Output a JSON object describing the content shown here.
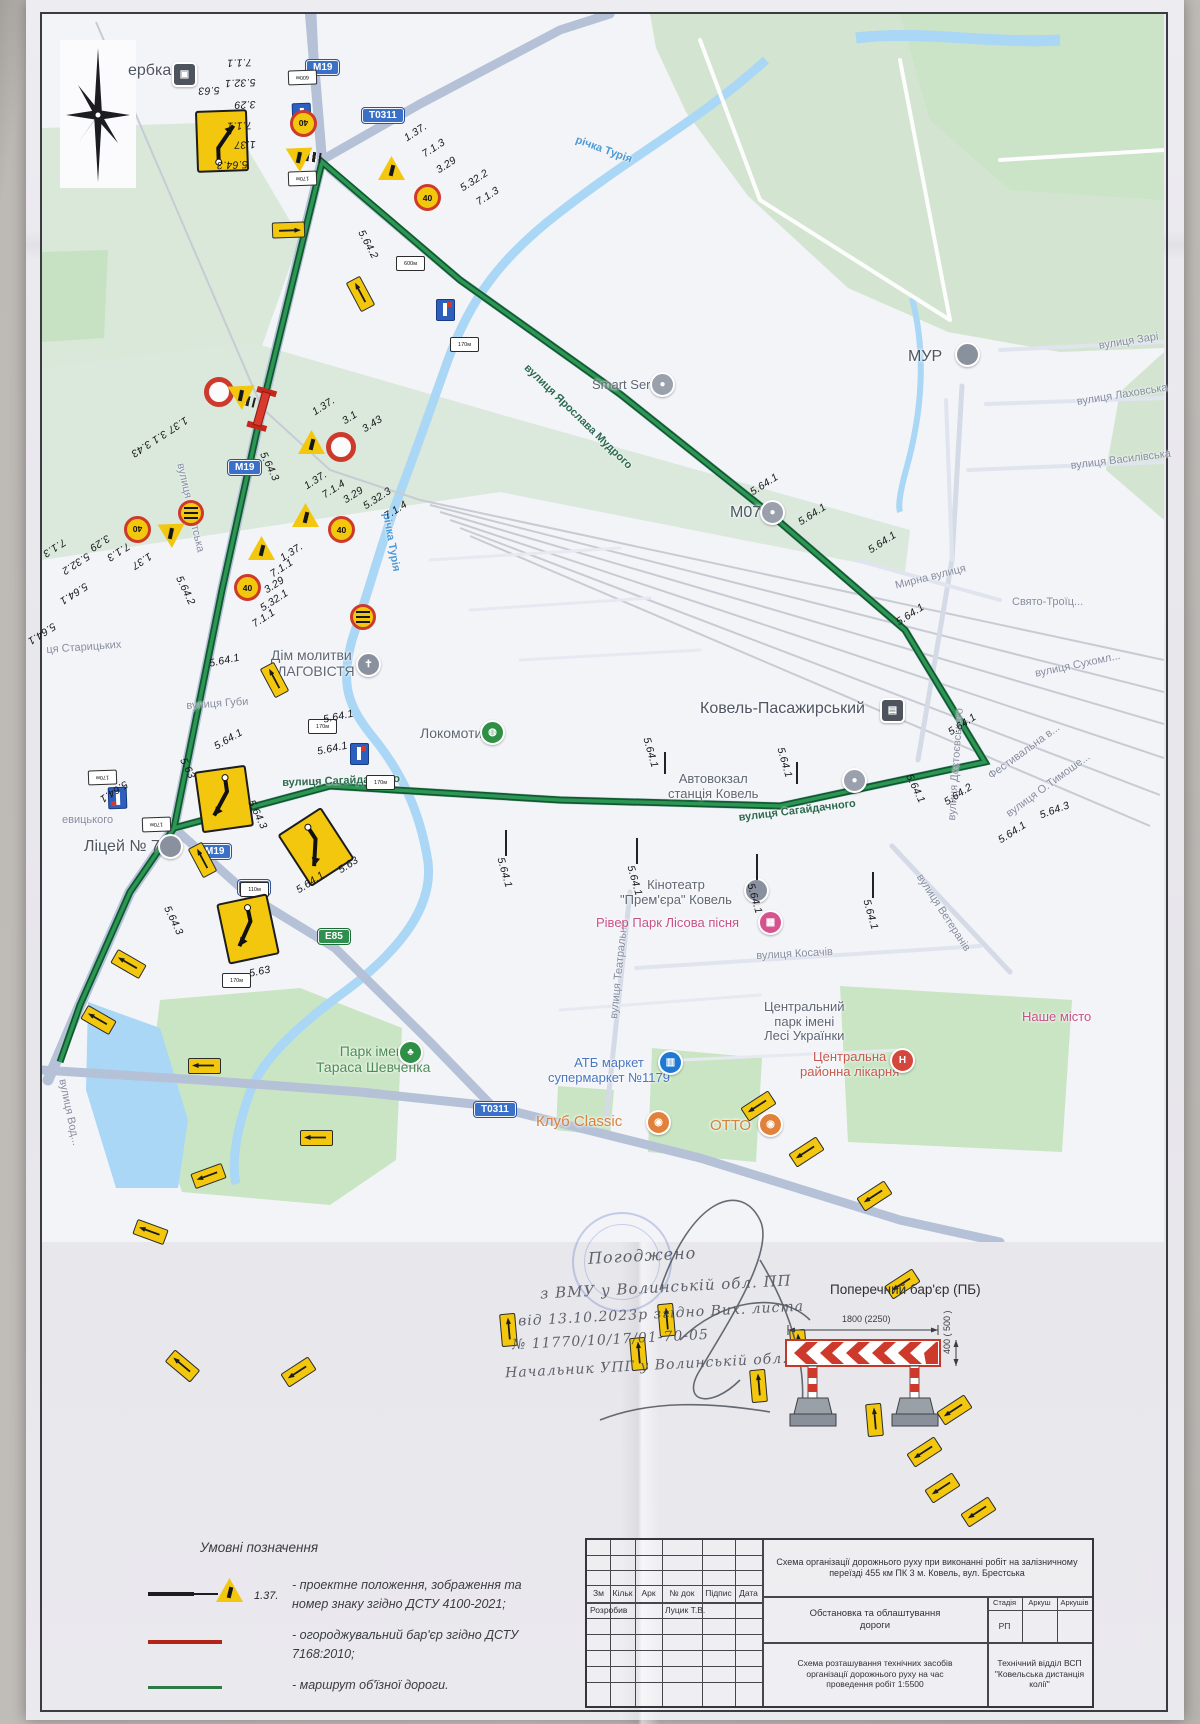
{
  "map": {
    "speed": "40",
    "plate_dist_600": "600м",
    "plate_dist_170": "170м",
    "plate_dist_110": "110м",
    "pois": [
      {
        "t": "ербка"
      },
      {
        "t": "МУР"
      },
      {
        "t": "Smart Service"
      },
      {
        "t": "М07"
      },
      {
        "t": "Дім молитви\nБЛАГОВІСТЯ"
      },
      {
        "t": "Локомотив"
      },
      {
        "t": "Ковель-Пасажирський"
      },
      {
        "t": "Автовокзал\nстанція Ковель"
      },
      {
        "t": "Кінотеатр\n\"Прем'єра\" Ковель"
      },
      {
        "t": "Рівер Парк Лісова пісня"
      },
      {
        "t": "Центральний\nпарк імені\nЛесі Українки"
      },
      {
        "t": "Наше місто"
      },
      {
        "t": "Центральна\nрайонна лікарня"
      },
      {
        "t": "АТБ маркет\nсупермаркет №1179"
      },
      {
        "t": "Клуб Classic"
      },
      {
        "t": "ОТТО"
      },
      {
        "t": "Парк імені\nТараса Шевченка"
      },
      {
        "t": "Ліцей № 7"
      }
    ],
    "streets": [
      {
        "t": "вулиця Зарі"
      },
      {
        "t": "вулиця Лаховська"
      },
      {
        "t": "вулиця Василівська"
      },
      {
        "t": "вулиця Достоєвського"
      },
      {
        "t": "Мирна вулиця"
      },
      {
        "t": "Свято-Троїц..."
      },
      {
        "t": "вулиця Сухомл..."
      },
      {
        "t": "вулиця Ярослава Мудрого"
      },
      {
        "t": "річка Турія"
      },
      {
        "t": "річка Турія"
      },
      {
        "t": "вулиця Брестська"
      },
      {
        "t": "ця Старицьких"
      },
      {
        "t": "вулиця Губи"
      },
      {
        "t": "вулиця Сагайдачного"
      },
      {
        "t": "вулиця Сагайдачного"
      },
      {
        "t": "вулиця Ветеранів"
      },
      {
        "t": "вулиця Театральна"
      },
      {
        "t": "вулиця Косачів"
      },
      {
        "t": "Фестивальна в..."
      },
      {
        "t": "вулиця О.Тимоше..."
      },
      {
        "t": "евицького"
      },
      {
        "t": "вулиця Вод..."
      }
    ],
    "shields": [
      {
        "t": "М19"
      },
      {
        "t": "Т0311"
      },
      {
        "t": "М19"
      },
      {
        "t": "М19"
      },
      {
        "t": "Р15"
      },
      {
        "t": "Е85"
      },
      {
        "t": "Т0311"
      }
    ],
    "signs": [
      {
        "t": "5.63"
      },
      {
        "t": "7.1.1"
      },
      {
        "t": "5.32.1"
      },
      {
        "t": "3.29"
      },
      {
        "t": "7.1.1"
      },
      {
        "t": "1.37"
      },
      {
        "t": "5.64.3"
      },
      {
        "t": "5.64.2"
      },
      {
        "t": "1.37."
      },
      {
        "t": "7.1.3"
      },
      {
        "t": "3.29"
      },
      {
        "t": "5.32.2"
      },
      {
        "t": "7.1.3"
      },
      {
        "t": "1.37  3.1  3.43"
      },
      {
        "t": "1.37."
      },
      {
        "t": "3.1"
      },
      {
        "t": "3.43"
      },
      {
        "t": "5.64.3"
      },
      {
        "t": "1.37."
      },
      {
        "t": "7.1.4"
      },
      {
        "t": "3.29"
      },
      {
        "t": "5.32.3"
      },
      {
        "t": "7.1.4"
      },
      {
        "t": "7.1.3"
      },
      {
        "t": "5.32.2"
      },
      {
        "t": "3.29"
      },
      {
        "t": "7.1.3"
      },
      {
        "t": "1.37"
      },
      {
        "t": "5.64.2"
      },
      {
        "t": "1.37."
      },
      {
        "t": "7.1.1"
      },
      {
        "t": "3.29"
      },
      {
        "t": "5.32.1"
      },
      {
        "t": "7.1.1"
      },
      {
        "t": "5.64.1"
      },
      {
        "t": "5.64.1"
      },
      {
        "t": "5.64.1"
      },
      {
        "t": "5.64.1"
      },
      {
        "t": "5.64.1"
      },
      {
        "t": "5.63"
      },
      {
        "t": "5.64.1"
      },
      {
        "t": "5.64.3"
      },
      {
        "t": "5.63"
      },
      {
        "t": "5.64.3"
      },
      {
        "t": "5.64.1"
      },
      {
        "t": "5.63"
      },
      {
        "t": "5.64.1"
      },
      {
        "t": "5.64.1"
      },
      {
        "t": "5.64.1"
      },
      {
        "t": "5.64.1"
      },
      {
        "t": "5.64.1"
      },
      {
        "t": "5.64.1"
      },
      {
        "t": "5.64.1"
      },
      {
        "t": "5.64.1"
      },
      {
        "t": "5.64.1"
      },
      {
        "t": "5.64.1"
      },
      {
        "t": "5.64.1"
      },
      {
        "t": "5.64.1"
      },
      {
        "t": "5.64.2"
      },
      {
        "t": "5.64.3"
      },
      {
        "t": "5.64.1"
      },
      {
        "t": "5.64.1"
      }
    ]
  },
  "note": {
    "lines": [
      {
        "t": "Погоджено"
      },
      {
        "t": "з ВМУ у Волинській обл. ПП"
      },
      {
        "t": "від 13.10.2023р згідно Вих. листа"
      },
      {
        "t": "№ 11770/10/17/01-70-05"
      },
      {
        "t": "Начальник УПГ у Волинській обл."
      }
    ]
  },
  "barrier": {
    "title": "Поперечний бар'єр (ПБ)",
    "dim_width": "1800 (2250)",
    "dim_height": "400 ( 500 )"
  },
  "legend": {
    "title": "Умовні позначення",
    "i1_code": "1.37.",
    "i1": "- проектне положення, зображення та\nномер знаку згідно ДСТУ 4100-2021;",
    "i2": "- огороджувальний бар'єр згідно ДСТУ\n7168:2010;",
    "i3": "- маршрут об'їзної дороги."
  },
  "tb": {
    "c0": "Зм",
    "c1": "Кільк",
    "c2": "Арк",
    "c3": "№ док",
    "c4": "Підпис",
    "c5": "Дата",
    "project": "Схема організації дорожнього руху при виконанні робіт на залізничному переїзді 455 км ПК 3 м. Ковель, вул. Брестська",
    "doc": "Обстановка та облаштування\nдороги",
    "s0": "Стадія",
    "s1": "Аркуш",
    "s2": "Аркушів",
    "stage": "РП",
    "dev": "Розробив",
    "devname": "Луцик Т.В.",
    "scheme": "Схема розташування технічних засобів\nорганізації дорожнього руху на час\nпроведення робіт 1:5500",
    "org": "Технічний відділ ВСП\n\"Ковельська дистанція\nколії\""
  }
}
